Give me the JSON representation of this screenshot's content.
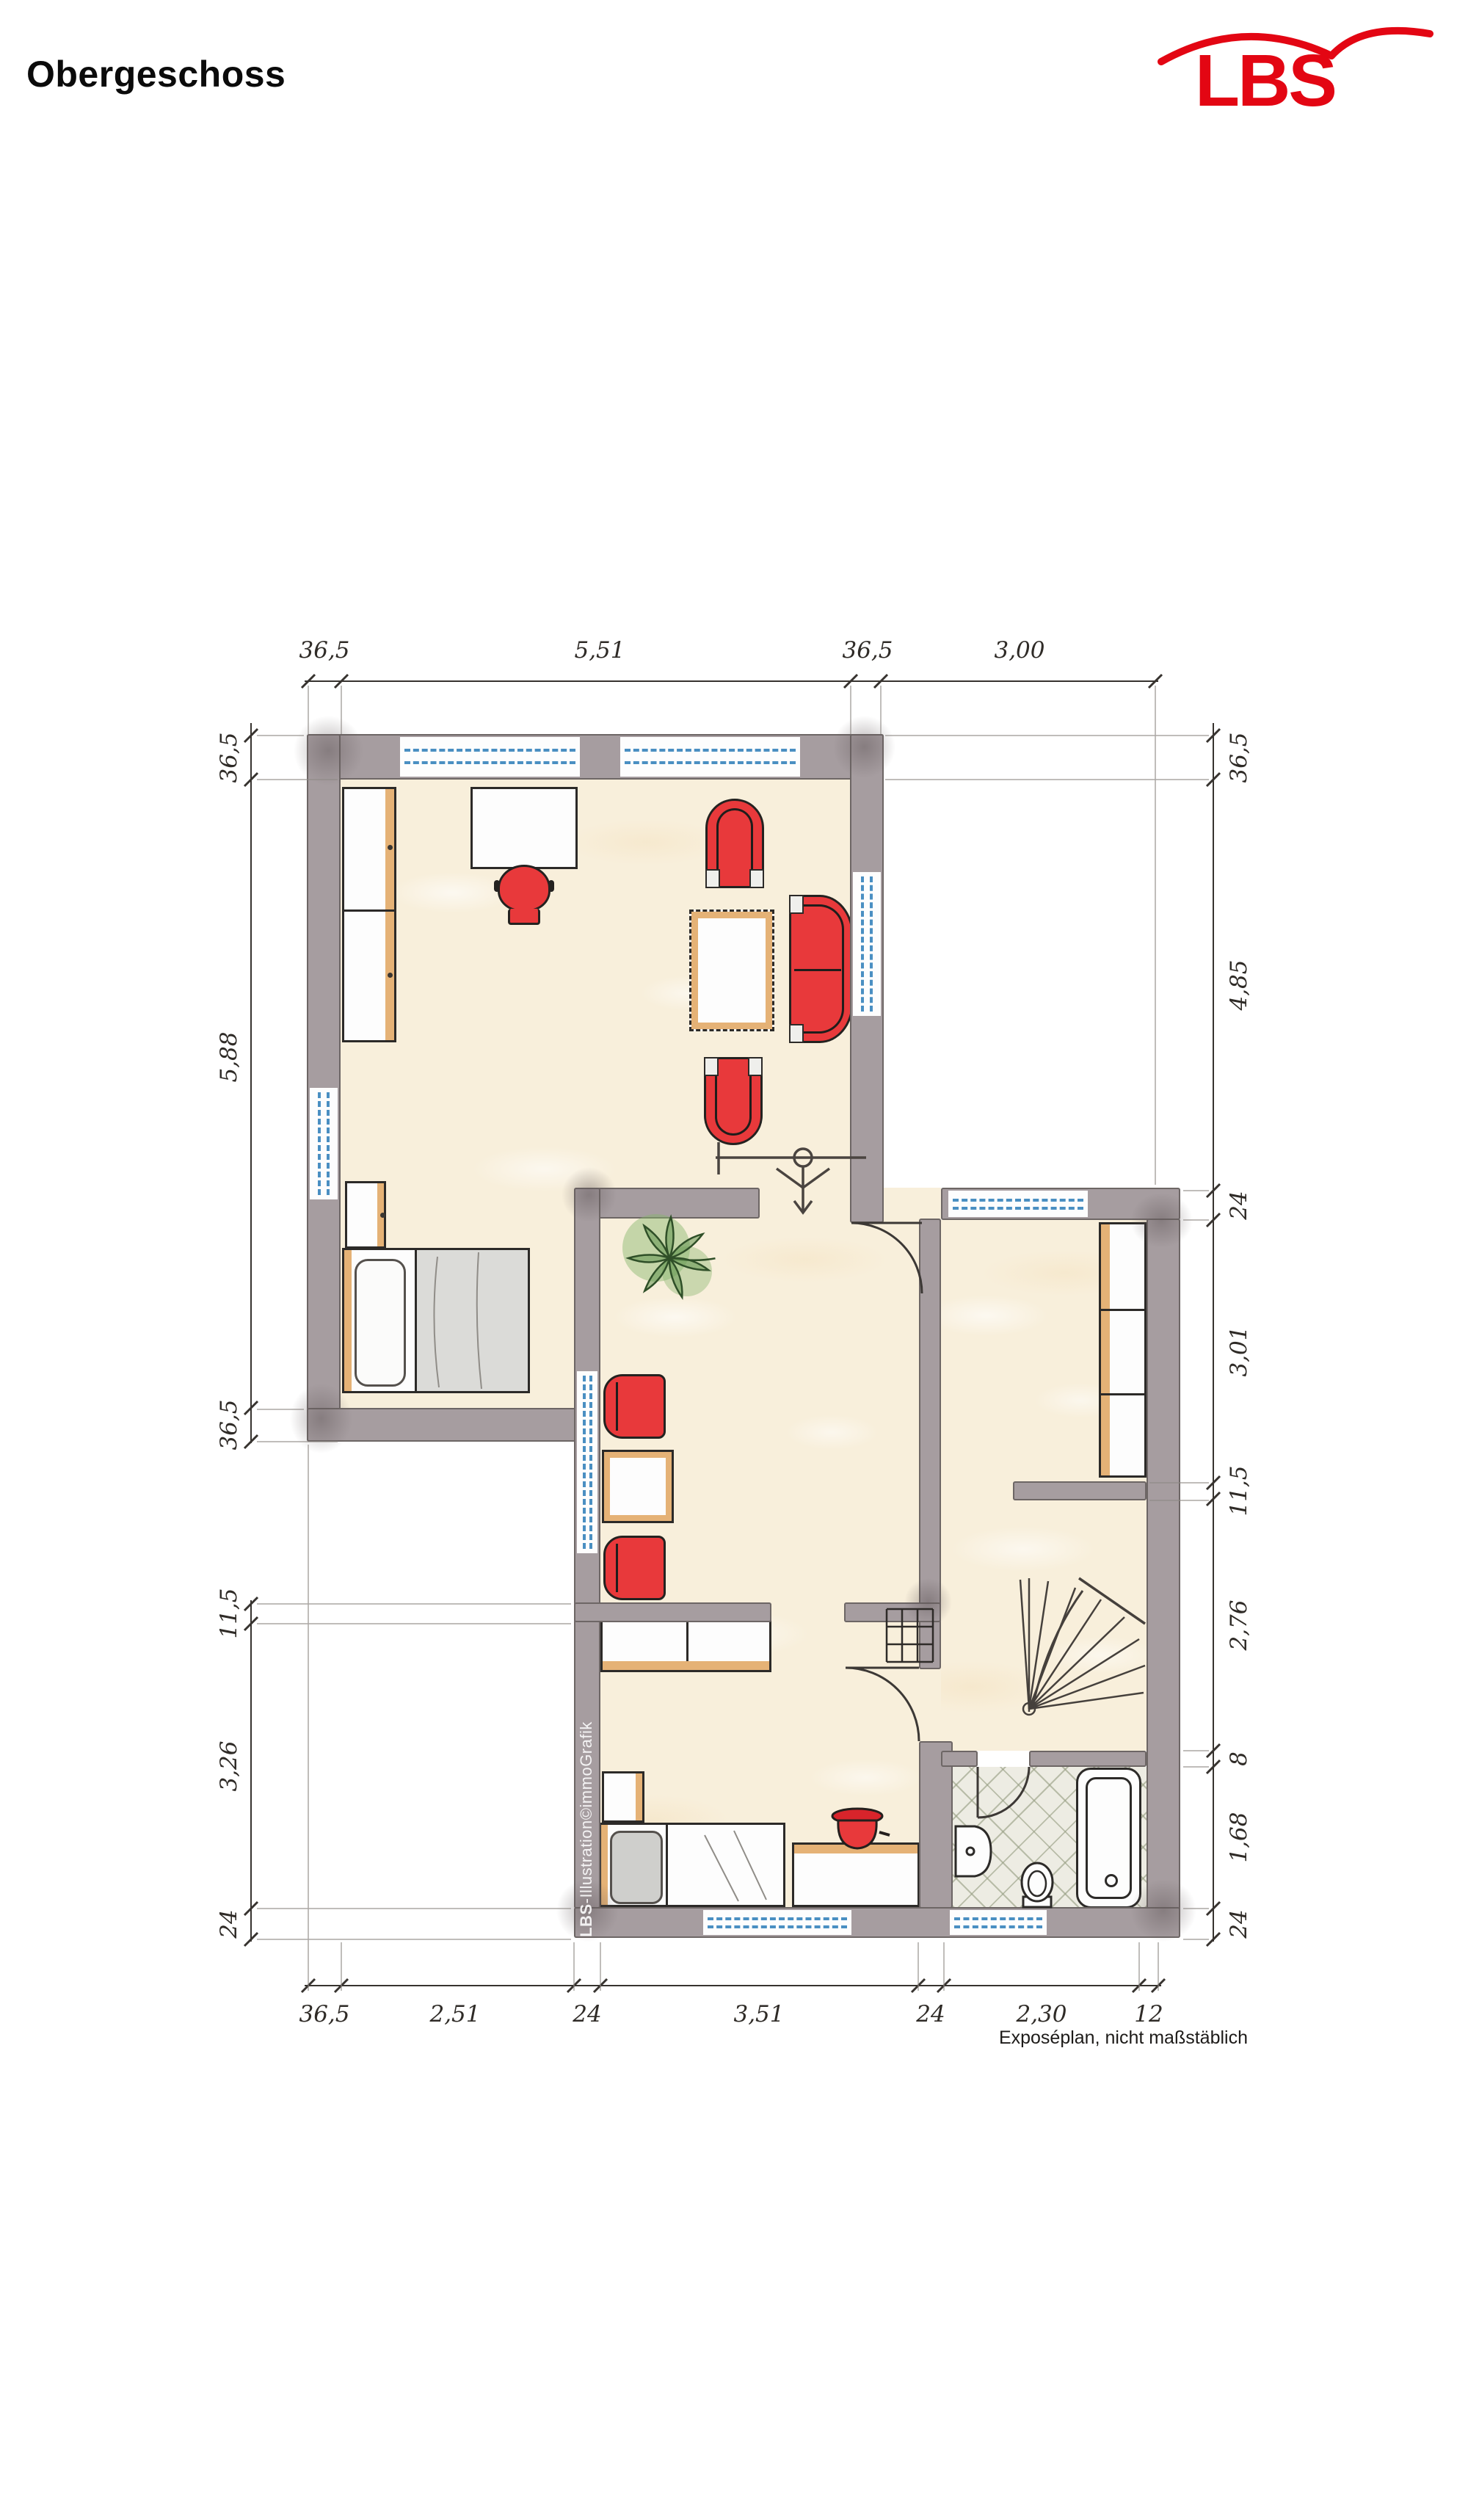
{
  "page": {
    "title": "Obergeschoss"
  },
  "logo": {
    "text": "LBS"
  },
  "plan": {
    "footnote": "Exposéplan, nicht maßstäblich",
    "watermark_bold": "LBS",
    "watermark_rest": "-Illustration©immoGrafik"
  },
  "dimensions": {
    "top": [
      "36,5",
      "5,51",
      "36,5",
      "3,00"
    ],
    "left_upper": [
      "36,5",
      "5,88",
      "36,5"
    ],
    "left_lower": [
      "11,5",
      "3,26",
      "24"
    ],
    "right": [
      "36,5",
      "4,85",
      "24",
      "3,01",
      "11,5",
      "2,76",
      "8",
      "1,68",
      "24"
    ],
    "bottom": [
      "36,5",
      "2,51",
      "24",
      "3,51",
      "24",
      "2,30",
      "12"
    ]
  },
  "colors": {
    "accent_red": "#e30613",
    "wall_gray": "#a69da0",
    "floor_cream": "#f8efdb",
    "window_blue": "#4a8fc2",
    "furniture_red": "#e8393b",
    "wood_tan": "#dca25e",
    "tile_gray": "#edece3"
  }
}
